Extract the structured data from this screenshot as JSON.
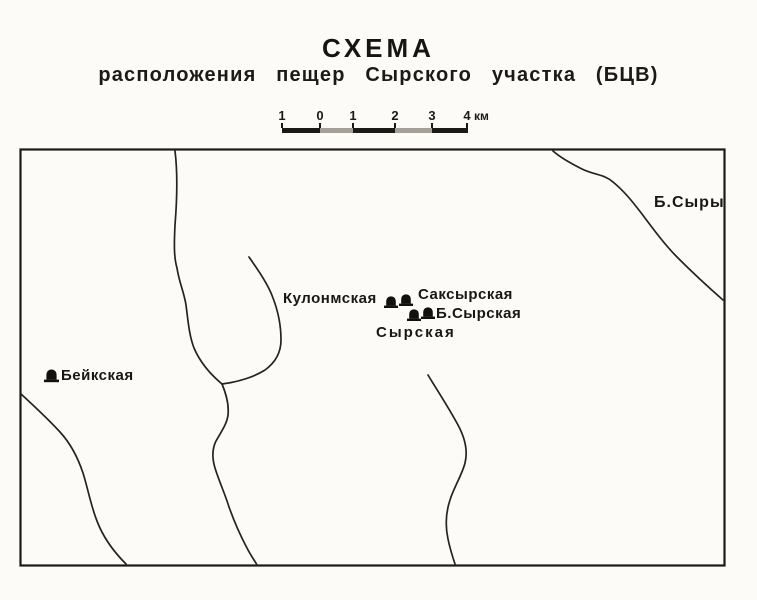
{
  "title": "СХЕМА",
  "subtitle": "расположения пещер Сырского участка (БЦВ)",
  "scale_bar": {
    "ticks": [
      "1",
      "0",
      "1",
      "2",
      "3",
      "4"
    ],
    "unit": "км"
  },
  "map": {
    "labels": [
      {
        "text": "Кулонмская",
        "type": "cave"
      },
      {
        "text": "Саксырская",
        "type": "cave"
      },
      {
        "text": "Б.Сырская",
        "type": "cave"
      },
      {
        "text": "Сырская",
        "type": "cave"
      },
      {
        "text": "Бейкская",
        "type": "cave"
      },
      {
        "text": "Б.Сыры",
        "type": "settlement"
      }
    ],
    "cave_symbol": "filled-mound-cave-entrance",
    "feature_counts": {
      "cave_symbols": 5,
      "rivers": 5
    }
  },
  "colors": {
    "ink": "#1b1a16",
    "paper": "#fcfbf7",
    "scale_light_segment": "#a49f97"
  }
}
